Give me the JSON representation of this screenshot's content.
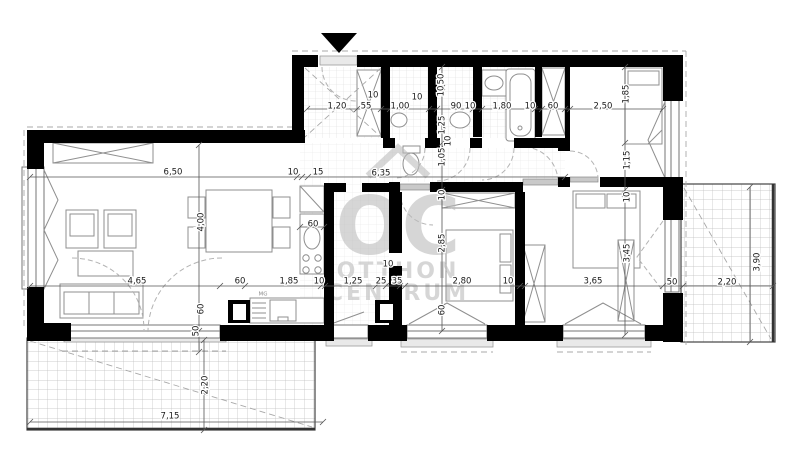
{
  "watermark": {
    "logo": "OC",
    "brand_line1": "OTTHON",
    "brand_line2": "CENTRUM",
    "color": "#bcbcbc"
  },
  "labels": {
    "washing_machine": "MG"
  },
  "colors": {
    "wall": "#000000",
    "dimension_text": "#1a1a1a",
    "furniture_line": "#8f8f8f"
  },
  "dimensions": [
    {
      "t": "1,20",
      "x": 337,
      "y": 106
    },
    {
      "t": "55",
      "x": 366,
      "y": 106
    },
    {
      "t": "10",
      "x": 373,
      "y": 95
    },
    {
      "t": "1,00",
      "x": 400,
      "y": 106
    },
    {
      "t": "10",
      "x": 417,
      "y": 97
    },
    {
      "t": "90",
      "x": 456,
      "y": 106
    },
    {
      "t": "10",
      "x": 470,
      "y": 106
    },
    {
      "t": "1,80",
      "x": 502,
      "y": 106
    },
    {
      "t": "10",
      "x": 530,
      "y": 106
    },
    {
      "t": "60",
      "x": 553,
      "y": 106
    },
    {
      "t": "2,50",
      "x": 603,
      "y": 106
    },
    {
      "t": "50",
      "x": 441,
      "y": 79,
      "r": 1
    },
    {
      "t": "10",
      "x": 441,
      "y": 91,
      "r": 1
    },
    {
      "t": "1,25",
      "x": 442,
      "y": 125,
      "r": 1
    },
    {
      "t": "10",
      "x": 448,
      "y": 141,
      "r": 1
    },
    {
      "t": "1,05",
      "x": 442,
      "y": 157,
      "r": 1
    },
    {
      "t": "10",
      "x": 442,
      "y": 195,
      "r": 1
    },
    {
      "t": "2,85",
      "x": 442,
      "y": 243,
      "r": 1
    },
    {
      "t": "60",
      "x": 442,
      "y": 310,
      "r": 1
    },
    {
      "t": "1,85",
      "x": 626,
      "y": 94,
      "r": 1
    },
    {
      "t": "1,15",
      "x": 627,
      "y": 160,
      "r": 1
    },
    {
      "t": "10",
      "x": 627,
      "y": 197,
      "r": 1
    },
    {
      "t": "3,45",
      "x": 627,
      "y": 253,
      "r": 1
    },
    {
      "t": "6,50",
      "x": 173,
      "y": 172
    },
    {
      "t": "10",
      "x": 293,
      "y": 172
    },
    {
      "t": "15",
      "x": 318,
      "y": 172
    },
    {
      "t": "6,35",
      "x": 381,
      "y": 173
    },
    {
      "t": "4,00",
      "x": 201,
      "y": 222,
      "r": 1
    },
    {
      "t": "60",
      "x": 201,
      "y": 309,
      "r": 1
    },
    {
      "t": "50",
      "x": 196,
      "y": 331,
      "r": 1
    },
    {
      "t": "60",
      "x": 313,
      "y": 224
    },
    {
      "t": "4,65",
      "x": 137,
      "y": 281
    },
    {
      "t": "60",
      "x": 240,
      "y": 281
    },
    {
      "t": "1,85",
      "x": 289,
      "y": 281
    },
    {
      "t": "10",
      "x": 319,
      "y": 281
    },
    {
      "t": "1,25",
      "x": 353,
      "y": 281
    },
    {
      "t": "25",
      "x": 381,
      "y": 281
    },
    {
      "t": "35",
      "x": 397,
      "y": 281
    },
    {
      "t": "10",
      "x": 388,
      "y": 264
    },
    {
      "t": "2,80",
      "x": 462,
      "y": 281
    },
    {
      "t": "10",
      "x": 508,
      "y": 281
    },
    {
      "t": "3,65",
      "x": 593,
      "y": 281
    },
    {
      "t": "50",
      "x": 672,
      "y": 282
    },
    {
      "t": "2,20",
      "x": 727,
      "y": 282
    },
    {
      "t": "3,90",
      "x": 757,
      "y": 262,
      "r": 1
    },
    {
      "t": "2,20",
      "x": 205,
      "y": 385,
      "r": 1
    },
    {
      "t": "7,15",
      "x": 170,
      "y": 416
    }
  ]
}
